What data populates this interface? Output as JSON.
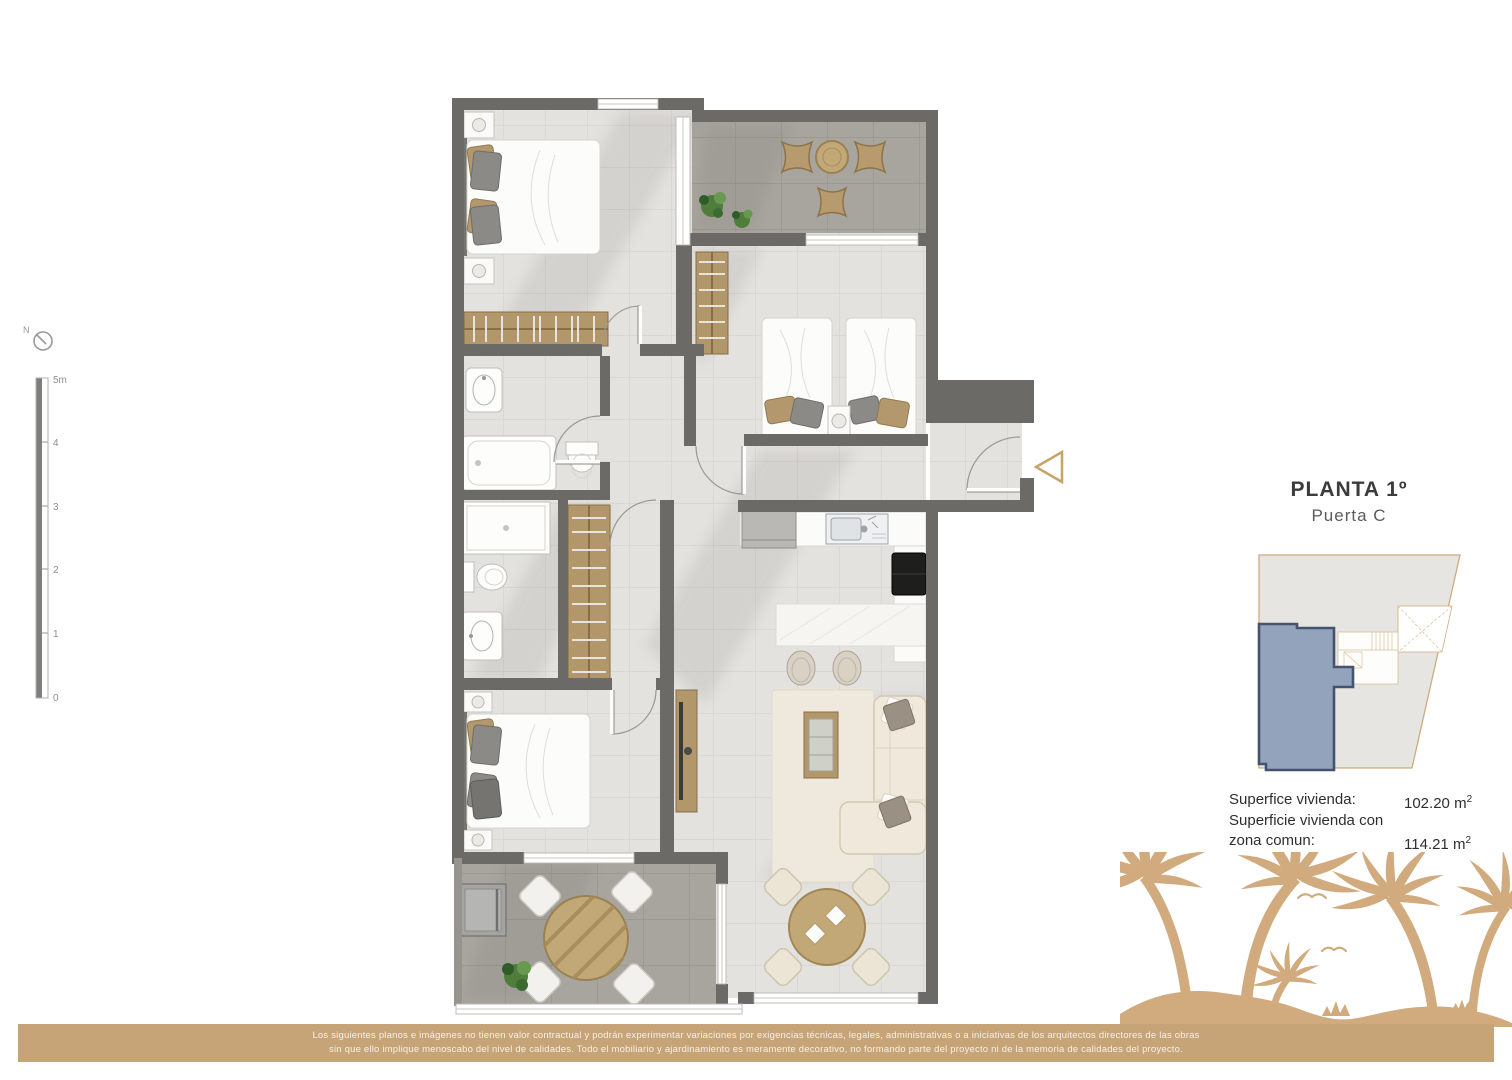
{
  "header": {
    "title": "PLANTA 1º",
    "subtitle": "Puerta C"
  },
  "compass": {
    "label": "N"
  },
  "scalebar": {
    "labels": [
      "5m",
      "4",
      "3",
      "2",
      "1",
      "0"
    ]
  },
  "areas": {
    "row1_label": "Superfice vivienda:",
    "row1_value": "102.20",
    "row2_label_line1": "Superficie vivienda con",
    "row2_label_line2": "zona comun:",
    "row2_value": "114.21",
    "unit_base": "m",
    "unit_sup": "2"
  },
  "footer": {
    "line1": "Los siguientes planos e imágenes no tienen valor contractual y podrán experimentar variaciones por exigencias técnicas, legales, administrativas o a iniciativas de los arquitectos directores de las obras",
    "line2": "sin que ello implique menoscabo del nivel de calidades. Todo el mobiliario y ajardinamiento es meramente decorativo, no formando parte del proyecto ni de la memoria de calidades del proyecto."
  },
  "colors": {
    "wall": "#6b6a66",
    "tile_light": "#e4e2de",
    "tile_dark": "#a8a59e",
    "wood": "#b2976b",
    "accent_gold": "#c9a265",
    "footer_tan": "#c7a478",
    "palm_tan": "#d1ab7e",
    "site_highlight_fill": "#94a3bc",
    "site_highlight_border": "#45536e",
    "site_outline": "#cbac7e"
  }
}
